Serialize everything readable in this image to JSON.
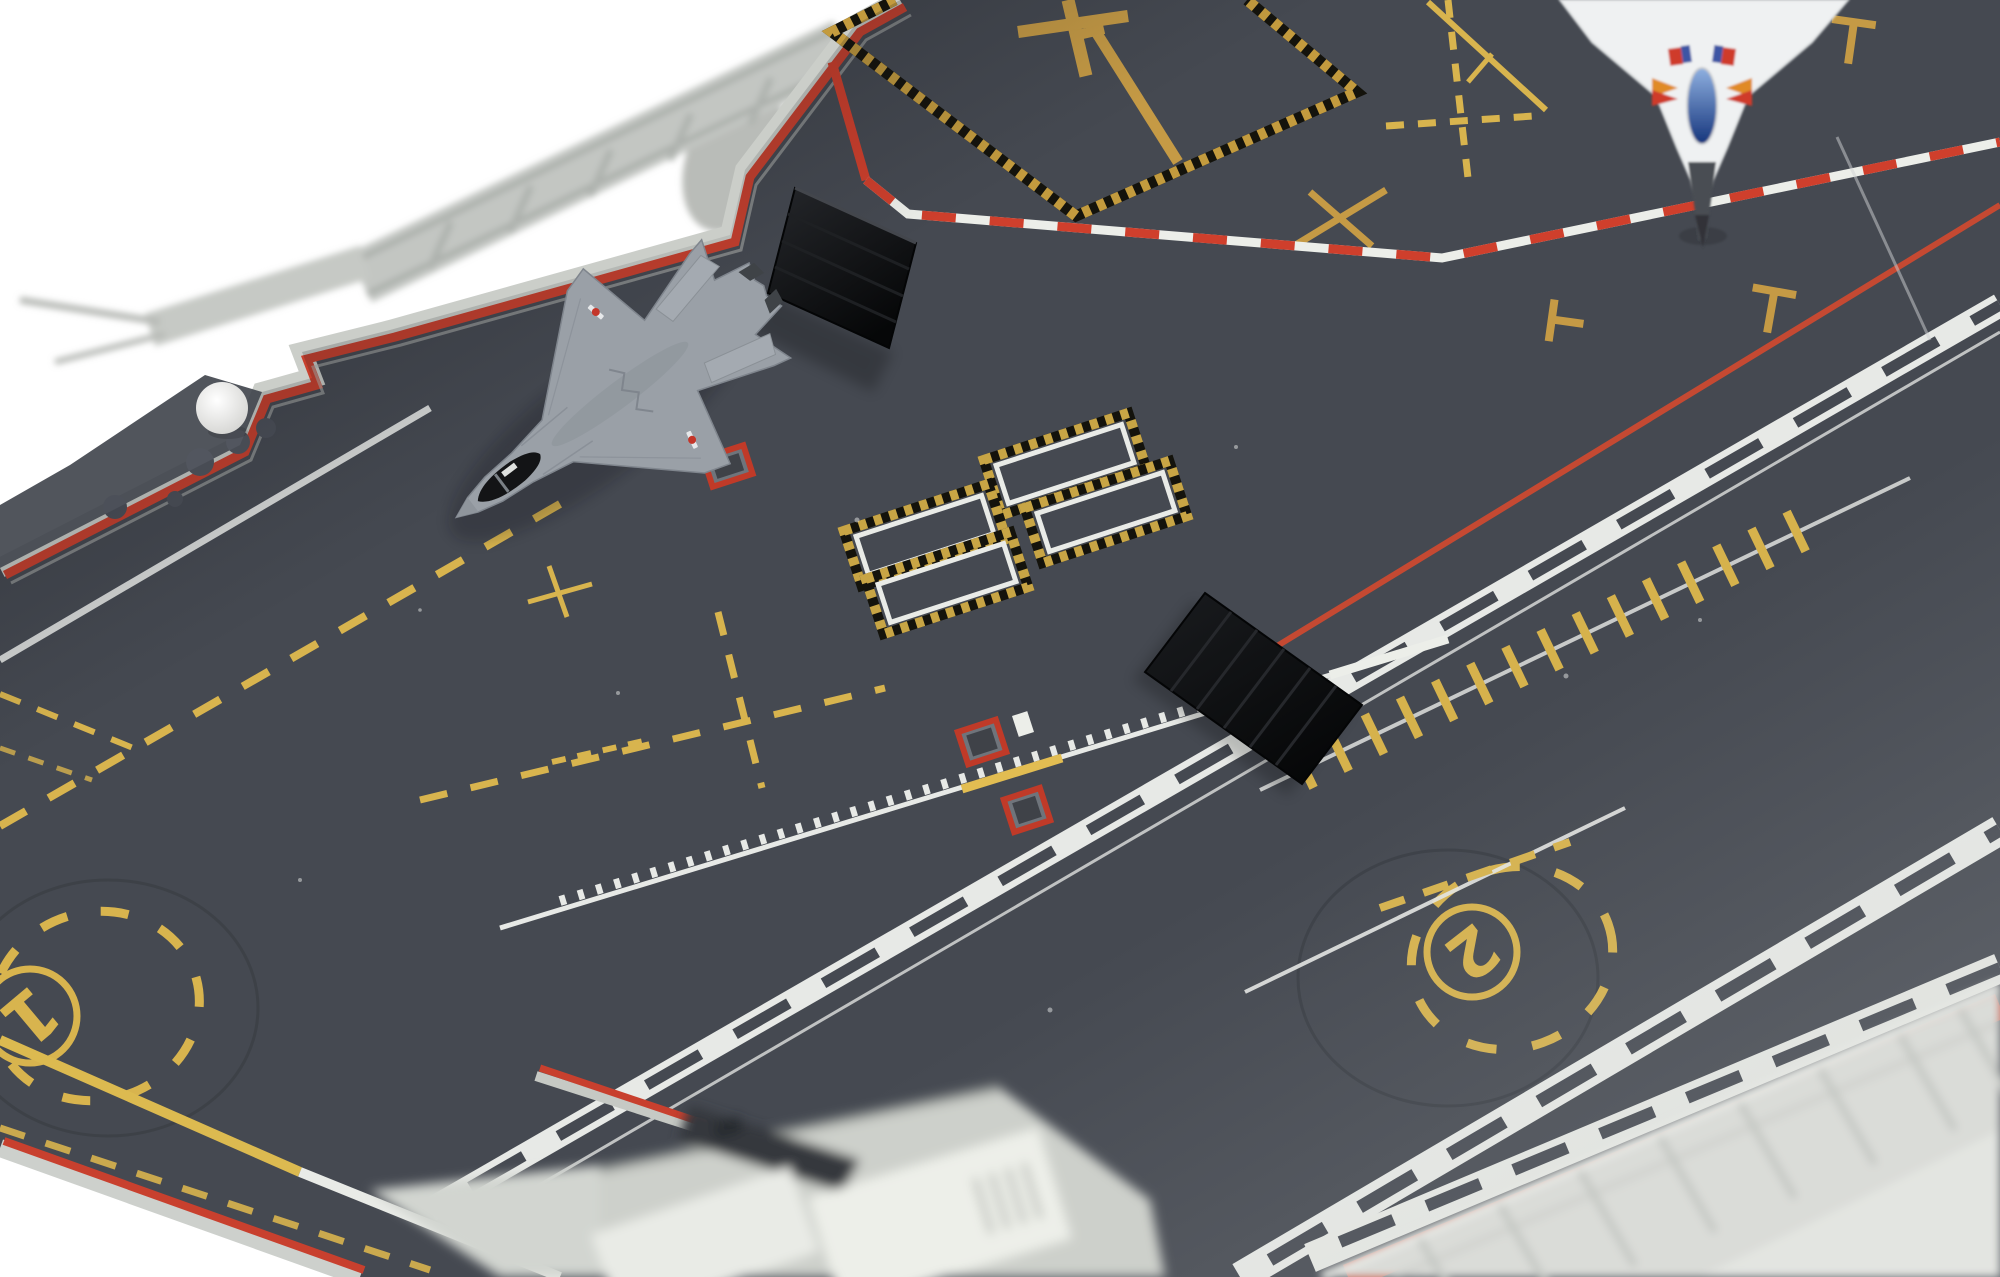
{
  "image": {
    "type": "photograph",
    "subject": "Scale model aircraft carrier flight deck viewed from above at an angle"
  },
  "palette": {
    "background": "#ffffff",
    "deck": "#454951",
    "deck_shadow": "#16181d",
    "deck_highlight": "#9a9ea2",
    "edge_red": "#c8402e",
    "rim_gray": "#cbcec9",
    "marking_yellow": "#d8b44e",
    "marking_gold": "#c59a45",
    "marking_white": "#eaece8",
    "foul_line_red": "#cf3f2c",
    "jbd_black": "#0b0c0e",
    "catwalk_gray": "#c6c9c4",
    "fighter_gray": "#9aa0a7",
    "white_jet": "#eff1f2",
    "canopy_blue": "#2b4f9e"
  },
  "deck_markings": {
    "catapult_spots": [
      {
        "id": "spot-2",
        "label": "2"
      },
      {
        "id": "spot-1",
        "label": "1"
      }
    ],
    "elevator_border_style": "yellow-black hazard dashes",
    "hatch_rectangles_count": 4,
    "red_safety_squares_count": 3,
    "t_marks_count": 3
  },
  "aircraft": [
    {
      "id": "stealth-fighter",
      "description": "gray twin-tail stealth fighter parked on bow, nose toward port edge",
      "canopy": "black"
    },
    {
      "id": "white-delta-jet",
      "description": "white delta-wing jet entering frame at top right, nose pointing down-deck",
      "canopy": "blue",
      "accent_colors": [
        "red",
        "blue",
        "orange"
      ]
    }
  ],
  "equipment": [
    {
      "id": "jbd-raised",
      "description": "raised black jet blast deflector panel"
    },
    {
      "id": "jbd-flat",
      "description": "flat black jet blast deflector with six slats"
    },
    {
      "id": "radome-ball",
      "description": "white spherical radome on port sponson"
    }
  ]
}
